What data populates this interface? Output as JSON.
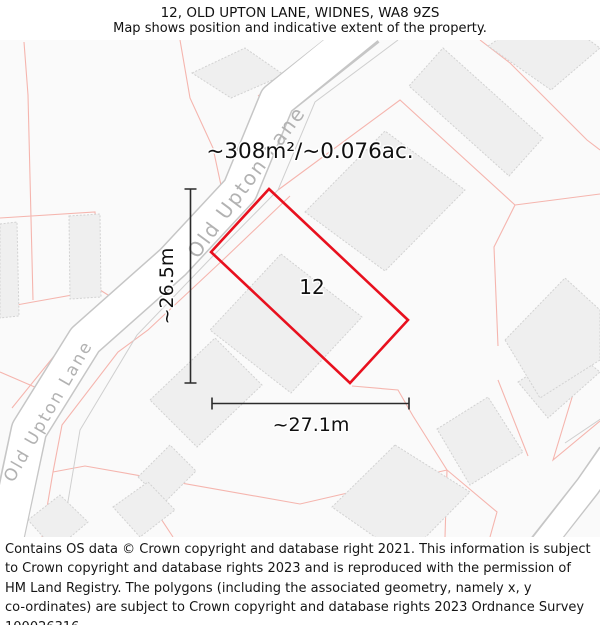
{
  "header": {
    "title": "12, OLD UPTON LANE, WIDNES, WA8 9ZS",
    "subtitle": "Map shows position and indicative extent of the property."
  },
  "map": {
    "area_label": "~308m²/~0.076ac.",
    "plot_number": "12",
    "width_label": "~27.1m",
    "height_label": "~26.5m",
    "road_label_upper": "Old Upton Lane",
    "road_label_lower": "Old Upton Lane",
    "colors": {
      "plot_outline": "#e8101e",
      "parcel_line": "#f5b5ae",
      "building_fill": "#efefef",
      "building_stroke": "#d2d2d2",
      "road_casing": "#c6c6c6",
      "road_fill": "#ffffff",
      "road_label": "#b2b2b2",
      "map_background": "#fafafa",
      "dimension_line": "#2b2b2b"
    }
  },
  "footer": {
    "lines": [
      "Contains OS data © Crown copyright and database right 2021. This information is subject",
      "to Crown copyright and database rights 2023 and is reproduced with the permission of",
      "HM Land Registry. The polygons (including the associated geometry, namely x, y",
      "co-ordinates) are subject to Crown copyright and database rights 2023 Ordnance Survey",
      "100026316."
    ]
  }
}
